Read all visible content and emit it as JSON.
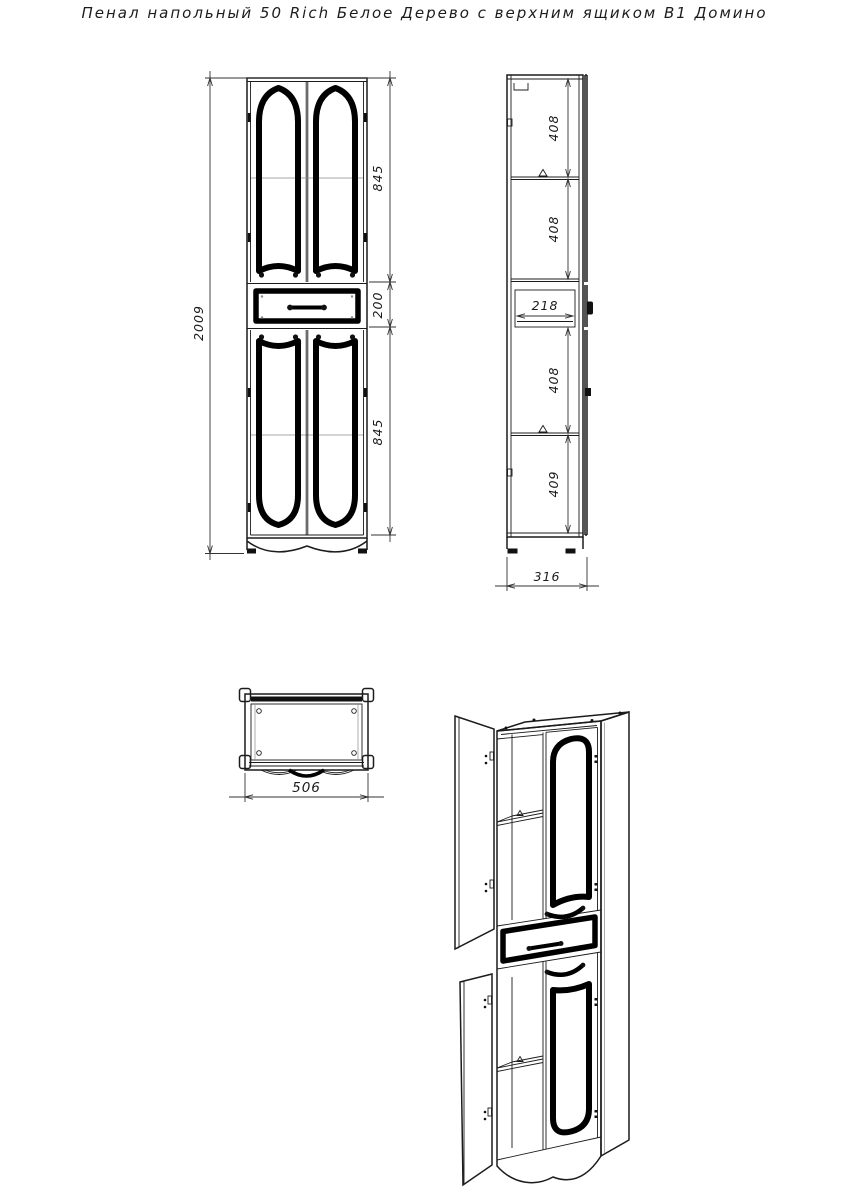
{
  "title": "Пенал напольный 50 Rich Белое Дерево с верхним ящиком В1 Домино",
  "colors": {
    "ink": "#1c1c1c",
    "panel_black": "#000000",
    "background": "#ffffff"
  },
  "views": {
    "front": {
      "dims": {
        "total_height": "2009",
        "upper_section": "845",
        "drawer_height": "200",
        "lower_section": "845"
      }
    },
    "side": {
      "dims": {
        "section1": "408",
        "section2": "408",
        "drawer_depth": "218",
        "section3": "408",
        "section4": "409",
        "total_depth": "316"
      }
    },
    "top": {
      "dims": {
        "total_width": "506"
      }
    }
  }
}
